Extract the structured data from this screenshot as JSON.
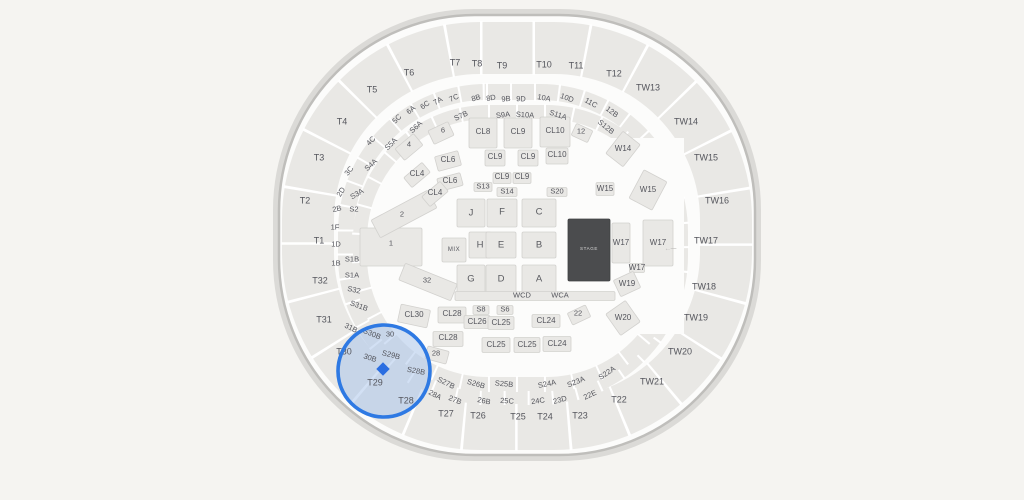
{
  "canvas": {
    "width": 1024,
    "height": 500
  },
  "colors": {
    "background": "#f5f4f1",
    "arena_fill": "#fcfcfb",
    "arena_border": "#bfbebb",
    "section_fill": "#e9e8e5",
    "section_border": "#d2d1ce",
    "label": "#54555c",
    "stage_fill": "#4b4c4e",
    "stage_text": "#d9d9d9",
    "highlight_ring": "#2e79e3",
    "highlight_fill": "#a9c4ea",
    "marker": "#2b6ee1"
  },
  "highlight": {
    "cx": 384,
    "cy": 371,
    "r": 46,
    "walkway": {
      "w": 104,
      "h": 14,
      "rot": 32
    },
    "marker": {
      "x": 383,
      "y": 369,
      "size": 9.5
    }
  },
  "labels": [
    {
      "t": "T1",
      "x": 319,
      "y": 241,
      "c": "t"
    },
    {
      "t": "T2",
      "x": 305,
      "y": 201,
      "c": "t"
    },
    {
      "t": "T3",
      "x": 319,
      "y": 158,
      "c": "t"
    },
    {
      "t": "T4",
      "x": 342,
      "y": 122,
      "c": "t"
    },
    {
      "t": "T5",
      "x": 372,
      "y": 90,
      "c": "t"
    },
    {
      "t": "T6",
      "x": 409,
      "y": 73,
      "c": "t"
    },
    {
      "t": "T7",
      "x": 455,
      "y": 63,
      "c": "t"
    },
    {
      "t": "T8",
      "x": 477,
      "y": 64,
      "c": "t"
    },
    {
      "t": "T9",
      "x": 502,
      "y": 66,
      "c": "t"
    },
    {
      "t": "T10",
      "x": 544,
      "y": 65,
      "c": "t"
    },
    {
      "t": "T11",
      "x": 576,
      "y": 66,
      "c": "t"
    },
    {
      "t": "T12",
      "x": 614,
      "y": 74,
      "c": "t"
    },
    {
      "t": "TW13",
      "x": 648,
      "y": 88,
      "c": "t"
    },
    {
      "t": "TW14",
      "x": 686,
      "y": 122,
      "c": "t"
    },
    {
      "t": "TW15",
      "x": 706,
      "y": 158,
      "c": "t"
    },
    {
      "t": "TW16",
      "x": 717,
      "y": 201,
      "c": "t"
    },
    {
      "t": "TW17",
      "x": 706,
      "y": 241,
      "c": "t"
    },
    {
      "t": "TW18",
      "x": 704,
      "y": 287,
      "c": "t"
    },
    {
      "t": "TW19",
      "x": 696,
      "y": 318,
      "c": "t"
    },
    {
      "t": "TW20",
      "x": 680,
      "y": 352,
      "c": "t"
    },
    {
      "t": "TW21",
      "x": 652,
      "y": 382,
      "c": "t"
    },
    {
      "t": "T22",
      "x": 619,
      "y": 400,
      "c": "t"
    },
    {
      "t": "T23",
      "x": 580,
      "y": 416,
      "c": "t"
    },
    {
      "t": "T24",
      "x": 545,
      "y": 417,
      "c": "t"
    },
    {
      "t": "T25",
      "x": 518,
      "y": 417,
      "c": "t"
    },
    {
      "t": "T26",
      "x": 478,
      "y": 416,
      "c": "t"
    },
    {
      "t": "T27",
      "x": 446,
      "y": 414,
      "c": "t"
    },
    {
      "t": "T28",
      "x": 406,
      "y": 401,
      "c": "t"
    },
    {
      "t": "T29",
      "x": 375,
      "y": 383,
      "c": "t"
    },
    {
      "t": "T30",
      "x": 344,
      "y": 352,
      "c": "t"
    },
    {
      "t": "T31",
      "x": 324,
      "y": 320,
      "c": "t"
    },
    {
      "t": "T32",
      "x": 320,
      "y": 281,
      "c": "t"
    },
    {
      "t": "5C",
      "x": 397,
      "y": 119,
      "c": "s"
    },
    {
      "t": "6A",
      "x": 411,
      "y": 110,
      "c": "s"
    },
    {
      "t": "6C",
      "x": 425,
      "y": 105,
      "c": "s"
    },
    {
      "t": "7A",
      "x": 438,
      "y": 101,
      "c": "s"
    },
    {
      "t": "7C",
      "x": 454,
      "y": 98,
      "c": "s"
    },
    {
      "t": "8B",
      "x": 476,
      "y": 98,
      "c": "s"
    },
    {
      "t": "8D",
      "x": 491,
      "y": 98,
      "c": "s"
    },
    {
      "t": "9B",
      "x": 506,
      "y": 99,
      "c": "s"
    },
    {
      "t": "9D",
      "x": 521,
      "y": 99,
      "c": "s"
    },
    {
      "t": "10A",
      "x": 544,
      "y": 98,
      "c": "s"
    },
    {
      "t": "10D",
      "x": 567,
      "y": 98,
      "c": "s"
    },
    {
      "t": "11C",
      "x": 591,
      "y": 103,
      "c": "s"
    },
    {
      "t": "12B",
      "x": 612,
      "y": 112,
      "c": "s"
    },
    {
      "t": "4C",
      "x": 371,
      "y": 141,
      "c": "s",
      "r": -46
    },
    {
      "t": "3C",
      "x": 349,
      "y": 171,
      "c": "s",
      "r": -52
    },
    {
      "t": "2D",
      "x": 341,
      "y": 192,
      "c": "s",
      "r": -58
    },
    {
      "t": "2B",
      "x": 337,
      "y": 209,
      "c": "s",
      "r": -12
    },
    {
      "t": "1F",
      "x": 335,
      "y": 227,
      "c": "s",
      "r": 0
    },
    {
      "t": "1D",
      "x": 336,
      "y": 244,
      "c": "s",
      "r": 0
    },
    {
      "t": "1B",
      "x": 336,
      "y": 263,
      "c": "s",
      "r": 0
    },
    {
      "t": "31B",
      "x": 351,
      "y": 328,
      "c": "s",
      "r": 26
    },
    {
      "t": "30B",
      "x": 370,
      "y": 358,
      "c": "s",
      "r": 18
    },
    {
      "t": "28A",
      "x": 435,
      "y": 395,
      "c": "s"
    },
    {
      "t": "27B",
      "x": 455,
      "y": 400,
      "c": "s"
    },
    {
      "t": "26B",
      "x": 484,
      "y": 401,
      "c": "s"
    },
    {
      "t": "25C",
      "x": 507,
      "y": 401,
      "c": "s"
    },
    {
      "t": "24C",
      "x": 538,
      "y": 401,
      "c": "s"
    },
    {
      "t": "23D",
      "x": 560,
      "y": 400,
      "c": "s"
    },
    {
      "t": "22E",
      "x": 590,
      "y": 395,
      "c": "s"
    },
    {
      "t": "S2",
      "x": 354,
      "y": 209,
      "c": "s",
      "r": 0
    },
    {
      "t": "S3A",
      "x": 357,
      "y": 194,
      "c": "s",
      "r": -30
    },
    {
      "t": "S4A",
      "x": 371,
      "y": 165,
      "c": "s",
      "r": -42
    },
    {
      "t": "S5A",
      "x": 391,
      "y": 144,
      "c": "s"
    },
    {
      "t": "S6A",
      "x": 416,
      "y": 127,
      "c": "s"
    },
    {
      "t": "S7B",
      "x": 461,
      "y": 116,
      "c": "s"
    },
    {
      "t": "S9A",
      "x": 503,
      "y": 115,
      "c": "s"
    },
    {
      "t": "S10A",
      "x": 525,
      "y": 115,
      "c": "s"
    },
    {
      "t": "S11A",
      "x": 558,
      "y": 115,
      "c": "s"
    },
    {
      "t": "S12B",
      "x": 606,
      "y": 127,
      "c": "s"
    },
    {
      "t": "S1B",
      "x": 352,
      "y": 259,
      "c": "s",
      "r": 0
    },
    {
      "t": "S1A",
      "x": 352,
      "y": 275,
      "c": "s",
      "r": 0
    },
    {
      "t": "S32",
      "x": 354,
      "y": 290,
      "c": "s",
      "r": 12
    },
    {
      "t": "S31B",
      "x": 359,
      "y": 306,
      "c": "s",
      "r": 20
    },
    {
      "t": "S30B",
      "x": 372,
      "y": 334,
      "c": "s",
      "r": 22
    },
    {
      "t": "S29B",
      "x": 391,
      "y": 355,
      "c": "s",
      "r": 14
    },
    {
      "t": "S28B",
      "x": 416,
      "y": 371,
      "c": "s",
      "r": 10
    },
    {
      "t": "S27B",
      "x": 446,
      "y": 383,
      "c": "s"
    },
    {
      "t": "S26B",
      "x": 476,
      "y": 384,
      "c": "s"
    },
    {
      "t": "S25B",
      "x": 504,
      "y": 384,
      "c": "s"
    },
    {
      "t": "S24A",
      "x": 547,
      "y": 384,
      "c": "s"
    },
    {
      "t": "S23A",
      "x": 576,
      "y": 382,
      "c": "s"
    },
    {
      "t": "S22A",
      "x": 607,
      "y": 373,
      "c": "s"
    },
    {
      "t": "6",
      "x": 443,
      "y": 130,
      "c": "n"
    },
    {
      "t": "4",
      "x": 409,
      "y": 144,
      "c": "n"
    },
    {
      "t": "12",
      "x": 581,
      "y": 131,
      "c": "n"
    },
    {
      "t": "28",
      "x": 436,
      "y": 353,
      "c": "n"
    },
    {
      "t": "30",
      "x": 390,
      "y": 334,
      "c": "n"
    },
    {
      "t": "22",
      "x": 578,
      "y": 313,
      "c": "n"
    },
    {
      "t": "32",
      "x": 427,
      "y": 280,
      "c": "n"
    },
    {
      "t": "1",
      "x": 391,
      "y": 243,
      "c": "n"
    },
    {
      "t": "2",
      "x": 402,
      "y": 214,
      "c": "n"
    },
    {
      "t": "S13",
      "x": 483,
      "y": 186,
      "c": "n"
    },
    {
      "t": "S14",
      "x": 507,
      "y": 191,
      "c": "n"
    },
    {
      "t": "S20",
      "x": 557,
      "y": 191,
      "c": "n"
    },
    {
      "t": "S8",
      "x": 481,
      "y": 309,
      "c": "n"
    },
    {
      "t": "S6",
      "x": 505,
      "y": 309,
      "c": "n"
    },
    {
      "t": "CL8",
      "x": 483,
      "y": 132,
      "c": "cl"
    },
    {
      "t": "CL9",
      "x": 518,
      "y": 132,
      "c": "cl"
    },
    {
      "t": "CL10",
      "x": 555,
      "y": 131,
      "c": "cl"
    },
    {
      "t": "CL9",
      "x": 495,
      "y": 157,
      "c": "cl"
    },
    {
      "t": "CL9",
      "x": 528,
      "y": 157,
      "c": "cl"
    },
    {
      "t": "CL10",
      "x": 557,
      "y": 155,
      "c": "cl"
    },
    {
      "t": "CL9",
      "x": 502,
      "y": 177,
      "c": "cl"
    },
    {
      "t": "CL9",
      "x": 522,
      "y": 177,
      "c": "cl"
    },
    {
      "t": "CL6",
      "x": 448,
      "y": 160,
      "c": "cl"
    },
    {
      "t": "CL6",
      "x": 450,
      "y": 181,
      "c": "cl"
    },
    {
      "t": "CL4",
      "x": 417,
      "y": 174,
      "c": "cl"
    },
    {
      "t": "CL4",
      "x": 435,
      "y": 193,
      "c": "cl"
    },
    {
      "t": "CL30",
      "x": 414,
      "y": 315,
      "c": "cl"
    },
    {
      "t": "CL28",
      "x": 452,
      "y": 314,
      "c": "cl"
    },
    {
      "t": "CL26",
      "x": 477,
      "y": 322,
      "c": "cl"
    },
    {
      "t": "CL25",
      "x": 501,
      "y": 323,
      "c": "cl"
    },
    {
      "t": "CL24",
      "x": 546,
      "y": 321,
      "c": "cl"
    },
    {
      "t": "CL28",
      "x": 448,
      "y": 338,
      "c": "cl"
    },
    {
      "t": "CL25",
      "x": 496,
      "y": 345,
      "c": "cl"
    },
    {
      "t": "CL25",
      "x": 527,
      "y": 345,
      "c": "cl"
    },
    {
      "t": "CL24",
      "x": 557,
      "y": 344,
      "c": "cl"
    },
    {
      "t": "W14",
      "x": 623,
      "y": 149,
      "c": "w"
    },
    {
      "t": "W15",
      "x": 605,
      "y": 189,
      "c": "w"
    },
    {
      "t": "W15",
      "x": 648,
      "y": 190,
      "c": "w"
    },
    {
      "t": "W17",
      "x": 621,
      "y": 243,
      "c": "w"
    },
    {
      "t": "W17",
      "x": 658,
      "y": 243,
      "c": "w"
    },
    {
      "t": "W17",
      "x": 637,
      "y": 268,
      "c": "w"
    },
    {
      "t": "W19",
      "x": 627,
      "y": 284,
      "c": "w"
    },
    {
      "t": "W20",
      "x": 623,
      "y": 318,
      "c": "w"
    },
    {
      "t": "J",
      "x": 471,
      "y": 213,
      "c": "f"
    },
    {
      "t": "F",
      "x": 502,
      "y": 212,
      "c": "f"
    },
    {
      "t": "C",
      "x": 539,
      "y": 212,
      "c": "f"
    },
    {
      "t": "H",
      "x": 480,
      "y": 245,
      "c": "f"
    },
    {
      "t": "E",
      "x": 501,
      "y": 245,
      "c": "f"
    },
    {
      "t": "B",
      "x": 539,
      "y": 245,
      "c": "f"
    },
    {
      "t": "G",
      "x": 471,
      "y": 279,
      "c": "f"
    },
    {
      "t": "D",
      "x": 501,
      "y": 279,
      "c": "f"
    },
    {
      "t": "A",
      "x": 539,
      "y": 279,
      "c": "f"
    },
    {
      "t": "WCD",
      "x": 522,
      "y": 295,
      "c": "wc"
    },
    {
      "t": "WCA",
      "x": 560,
      "y": 295,
      "c": "wc"
    },
    {
      "t": "MIX",
      "x": 454,
      "y": 250,
      "c": "mix"
    },
    {
      "t": "STAGE",
      "x": 589,
      "y": 249,
      "c": "stg"
    },
    {
      "t": "←----",
      "x": 670,
      "y": 249,
      "c": "ar"
    }
  ],
  "blocks": [
    {
      "x": 471,
      "y": 213,
      "w": 28,
      "h": 28
    },
    {
      "x": 502,
      "y": 213,
      "w": 30,
      "h": 28
    },
    {
      "x": 539,
      "y": 213,
      "w": 34,
      "h": 28
    },
    {
      "x": 480,
      "y": 245,
      "w": 22,
      "h": 26
    },
    {
      "x": 501,
      "y": 245,
      "w": 30,
      "h": 26
    },
    {
      "x": 539,
      "y": 245,
      "w": 34,
      "h": 26
    },
    {
      "x": 471,
      "y": 280,
      "w": 28,
      "h": 30
    },
    {
      "x": 501,
      "y": 280,
      "w": 30,
      "h": 30
    },
    {
      "x": 539,
      "y": 280,
      "w": 34,
      "h": 30
    },
    {
      "x": 454,
      "y": 250,
      "w": 24,
      "h": 24
    },
    {
      "x": 535,
      "y": 296,
      "w": 160,
      "h": 9
    },
    {
      "x": 391,
      "y": 247,
      "w": 62,
      "h": 38
    },
    {
      "x": 404,
      "y": 214,
      "w": 64,
      "h": 20,
      "r": -28
    },
    {
      "x": 428,
      "y": 282,
      "w": 56,
      "h": 18,
      "r": 22
    },
    {
      "x": 483,
      "y": 133,
      "w": 28,
      "h": 30
    },
    {
      "x": 518,
      "y": 133,
      "w": 28,
      "h": 30
    },
    {
      "x": 555,
      "y": 132,
      "w": 30,
      "h": 30
    },
    {
      "x": 495,
      "y": 158,
      "w": 20,
      "h": 16
    },
    {
      "x": 528,
      "y": 158,
      "w": 20,
      "h": 16
    },
    {
      "x": 557,
      "y": 156,
      "w": 22,
      "h": 16
    },
    {
      "x": 502,
      "y": 178,
      "w": 18,
      "h": 11
    },
    {
      "x": 522,
      "y": 178,
      "w": 18,
      "h": 11
    },
    {
      "x": 483,
      "y": 187,
      "w": 18,
      "h": 9
    },
    {
      "x": 507,
      "y": 192,
      "w": 20,
      "h": 9
    },
    {
      "x": 557,
      "y": 192,
      "w": 20,
      "h": 9
    },
    {
      "x": 448,
      "y": 161,
      "w": 24,
      "h": 15,
      "r": -15
    },
    {
      "x": 450,
      "y": 182,
      "w": 24,
      "h": 13,
      "r": -15
    },
    {
      "x": 417,
      "y": 175,
      "w": 24,
      "h": 13,
      "r": -40
    },
    {
      "x": 435,
      "y": 194,
      "w": 24,
      "h": 13,
      "r": -40
    },
    {
      "x": 441,
      "y": 133,
      "w": 22,
      "h": 15,
      "r": -25
    },
    {
      "x": 409,
      "y": 147,
      "w": 24,
      "h": 15,
      "r": -40
    },
    {
      "x": 582,
      "y": 133,
      "w": 18,
      "h": 13,
      "r": 25
    },
    {
      "x": 414,
      "y": 316,
      "w": 30,
      "h": 18,
      "r": 12
    },
    {
      "x": 452,
      "y": 315,
      "w": 28,
      "h": 16
    },
    {
      "x": 477,
      "y": 322,
      "w": 26,
      "h": 13
    },
    {
      "x": 501,
      "y": 323,
      "w": 26,
      "h": 13
    },
    {
      "x": 546,
      "y": 321,
      "w": 28,
      "h": 13
    },
    {
      "x": 448,
      "y": 339,
      "w": 30,
      "h": 15
    },
    {
      "x": 496,
      "y": 345,
      "w": 28,
      "h": 15
    },
    {
      "x": 527,
      "y": 345,
      "w": 26,
      "h": 15
    },
    {
      "x": 557,
      "y": 344,
      "w": 28,
      "h": 15
    },
    {
      "x": 481,
      "y": 310,
      "w": 16,
      "h": 9
    },
    {
      "x": 505,
      "y": 310,
      "w": 16,
      "h": 9
    },
    {
      "x": 437,
      "y": 355,
      "w": 22,
      "h": 13,
      "r": 15
    },
    {
      "x": 579,
      "y": 315,
      "w": 20,
      "h": 13,
      "r": -25
    },
    {
      "x": 623,
      "y": 149,
      "w": 22,
      "h": 28,
      "r": 38
    },
    {
      "x": 605,
      "y": 189,
      "w": 18,
      "h": 13
    },
    {
      "x": 648,
      "y": 190,
      "w": 26,
      "h": 32,
      "r": 28
    },
    {
      "x": 621,
      "y": 243,
      "w": 18,
      "h": 40
    },
    {
      "x": 658,
      "y": 243,
      "w": 30,
      "h": 46
    },
    {
      "x": 637,
      "y": 268,
      "w": 15,
      "h": 9
    },
    {
      "x": 627,
      "y": 284,
      "w": 22,
      "h": 18,
      "r": -25
    },
    {
      "x": 623,
      "y": 318,
      "w": 24,
      "h": 26,
      "r": -35
    },
    {
      "x": 589,
      "y": 250,
      "w": 42,
      "h": 62,
      "k": "stage"
    }
  ]
}
